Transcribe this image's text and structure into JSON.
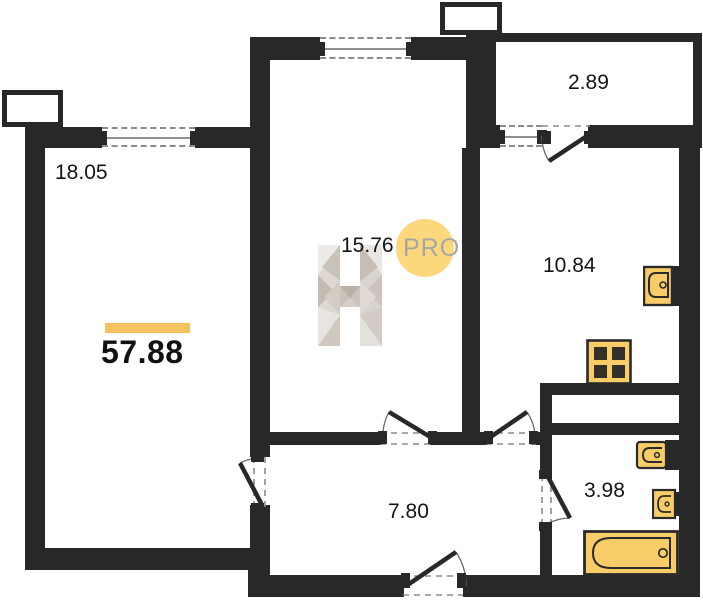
{
  "plan": {
    "total": {
      "area": "57.88"
    },
    "rooms": {
      "living": {
        "area": "18.05"
      },
      "bedroom": {
        "area": "15.76"
      },
      "loggia": {
        "area": "2.89"
      },
      "kitchen": {
        "area": "10.84"
      },
      "hallway": {
        "area": "7.80"
      },
      "bathroom": {
        "area": "3.98"
      }
    },
    "watermark": {
      "badge": "PRO"
    },
    "fixtures": [
      "kitchen-sink",
      "stove",
      "toilet",
      "wash-sink",
      "bathtub"
    ],
    "colors": {
      "wall": "#282828",
      "fixture_fill": "#f8cd68",
      "accent_bar": "#f5c25d",
      "badge_fill": "#fbd87c",
      "badge_text": "#a6a6a6"
    }
  }
}
